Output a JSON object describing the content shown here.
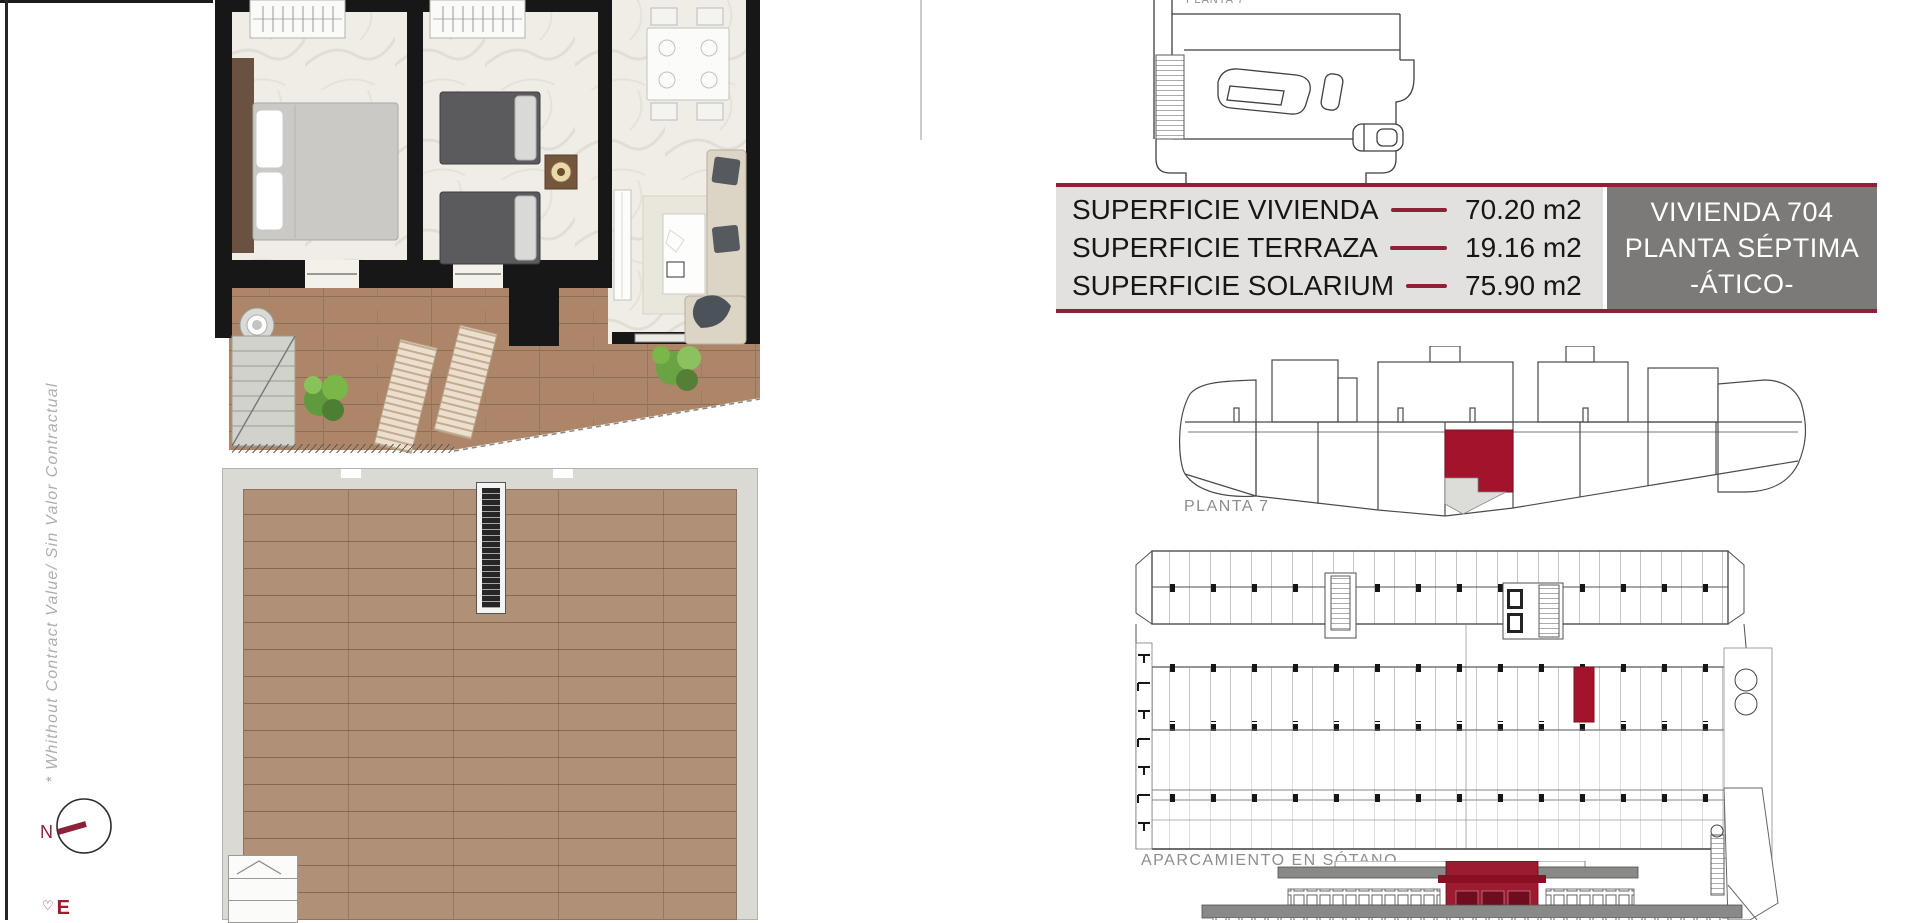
{
  "page": {
    "side_note": "* Whithout Contract Value/ Sin Valor Contractual",
    "compass": {
      "north_label": "N"
    },
    "brand_fragment": {
      "mark": "♡",
      "letter": "E"
    }
  },
  "surface_table": {
    "rows": [
      {
        "label": "SUPERFICIE VIVIENDA",
        "value": "70.20 m2"
      },
      {
        "label": "SUPERFICIE TERRAZA",
        "value": "19.16 m2"
      },
      {
        "label": "SUPERFICIE SOLARIUM",
        "value": "75.90 m2"
      }
    ],
    "unit_box": {
      "line1": "VIVIENDA 704",
      "line2": "PLANTA SÉPTIMA",
      "line3": "-ÁTICO-"
    }
  },
  "plans": {
    "atico_top_label": "PLANTA 7",
    "key_plan_label": "PLANTA 7",
    "parking_label": "APARCAMIENTO EN SÓTANO"
  },
  "colors": {
    "maroon_accent": "#8C2138",
    "highlight_red": "#A3132B",
    "elevation_red": "#9D1B2E",
    "unit_box_gray": "#7B7A78",
    "table_gray": "#E2E1DF",
    "label_gray": "#8D8D8D",
    "wood_floor": "#B19078",
    "wall_black": "#171717"
  }
}
